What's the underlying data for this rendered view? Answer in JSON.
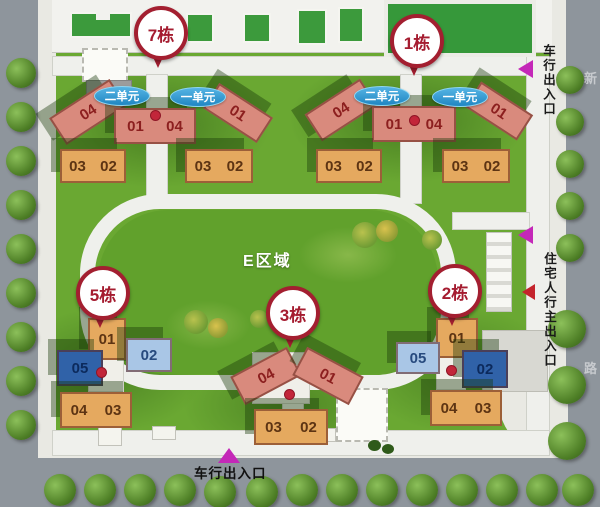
{
  "map": {
    "area_label": "E区域",
    "oval_unit2": "二单元",
    "oval_unit1": "一单元",
    "entrance_vehicle_right": "车行出入口",
    "entrance_pedestrian_right": "住宅人行主出入口",
    "entrance_vehicle_bottom": "车行出入口",
    "street_char_top": "新",
    "street_char_bottom": "路",
    "colors": {
      "marker_red": "#a31f30",
      "oval_blue": "#2b93cf",
      "salmon": "#d98a7d",
      "orange": "#e5a95f",
      "dark_blue": "#3062a8",
      "light_blue": "#a9c6e6",
      "grass": "#6aa832",
      "road": "#8e959c"
    },
    "buildings": {
      "b7": {
        "name": "7栋",
        "wing_left": "04",
        "center_left": "01",
        "center_right": "04",
        "wing_right": "01",
        "low_left_a": "03",
        "low_left_b": "02",
        "low_right_a": "03",
        "low_right_b": "02"
      },
      "b1": {
        "name": "1栋",
        "wing_left": "04",
        "center_left": "01",
        "center_right": "04",
        "wing_right": "01",
        "low_left_a": "03",
        "low_left_b": "02",
        "low_right_a": "03",
        "low_right_b": "02"
      },
      "b3": {
        "name": "3栋",
        "wing_left": "04",
        "wing_right": "01",
        "low_a": "03",
        "low_b": "02"
      },
      "b5": {
        "name": "5栋",
        "top": "01",
        "light": "02",
        "dark": "05",
        "low_a": "04",
        "low_b": "03"
      },
      "b2": {
        "name": "2栋",
        "top": "01",
        "light": "05",
        "dark": "02",
        "low_a": "04",
        "low_b": "03"
      }
    }
  }
}
